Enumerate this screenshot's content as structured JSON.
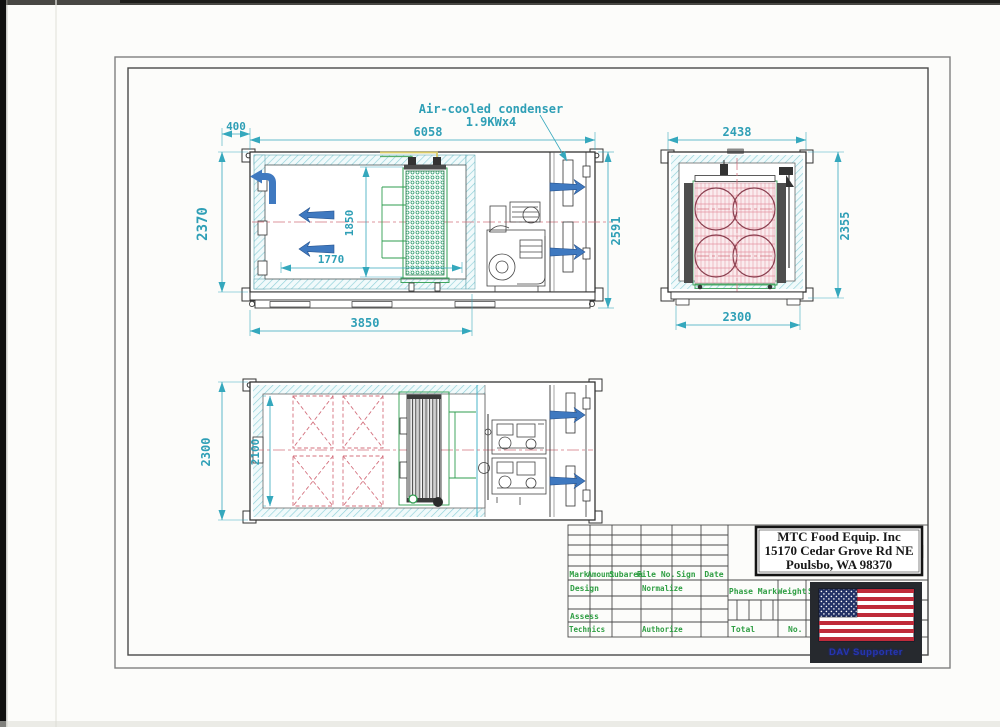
{
  "annotations": {
    "condenser_label_line1": "Air-cooled condenser",
    "condenser_label_line2": "1.9KWx4"
  },
  "dimensions": {
    "side": {
      "offset": "400",
      "overall_length": "6058",
      "height": "2370",
      "inner_height": "1850",
      "inner_length": "1770",
      "overall_height": "2591",
      "base_length": "3850"
    },
    "end": {
      "overall_width": "2438",
      "height": "2355",
      "base_width": "2300"
    },
    "plan": {
      "overall_depth": "2300",
      "inner_depth": "2100"
    }
  },
  "title_block": {
    "company_name": "MTC Food Equip. Inc",
    "company_address_line1": "15170 Cedar Grove Rd NE",
    "company_address_line2": "Poulsbo, WA 98370",
    "columns": {
      "mark": "Mark",
      "amount": "Amount",
      "subarea": "Subarea",
      "file_no": "File No.",
      "sign": "Sign",
      "date": "Date"
    },
    "rows": {
      "design": "Design",
      "normalize": "Normalize",
      "assess": "Assess",
      "technics": "Technics",
      "authorize": "Authorize"
    },
    "right": {
      "phase_mark": "Phase Mark",
      "weight": "Weight",
      "scale": "Scale",
      "total": "Total",
      "no": "No."
    },
    "flag_caption": "DAV Supporter"
  }
}
